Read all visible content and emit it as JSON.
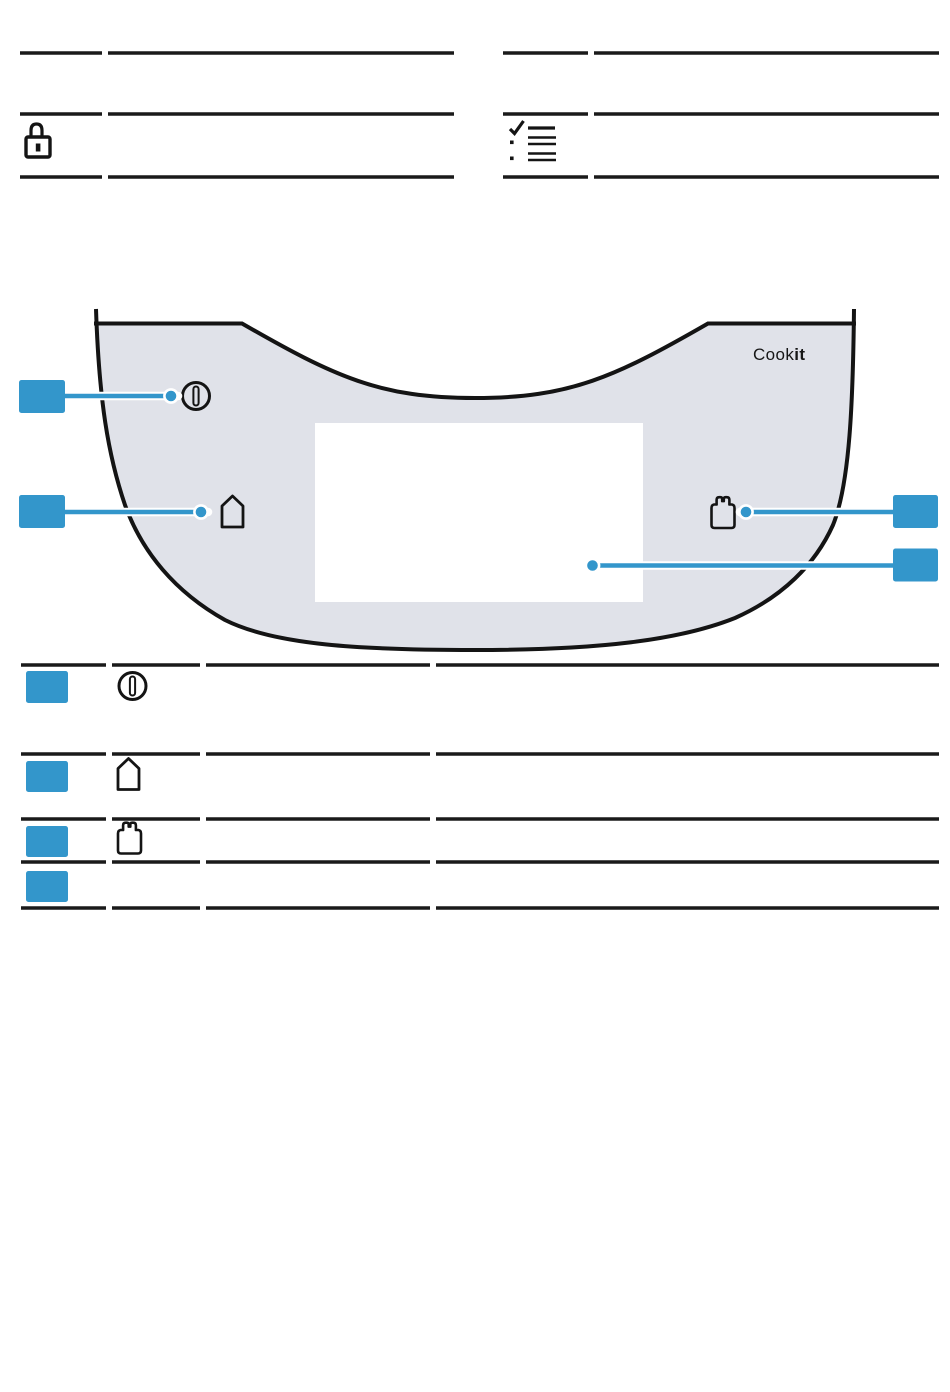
{
  "page": {
    "kind": "appliance-manual-page",
    "background": "#ffffff"
  },
  "colors": {
    "accent_blue": "#3396cb",
    "panel_fill": "#e0e2e9",
    "rule_black": "#1a1a1a",
    "display_white": "#ffffff"
  },
  "header": {
    "left_table": {
      "rows": [
        {
          "icon": null,
          "content": ""
        },
        {
          "icon": "lock-icon",
          "content": ""
        }
      ]
    },
    "right_table": {
      "rows": [
        {
          "icon": null,
          "content": ""
        },
        {
          "icon": "checklist-icon",
          "content": ""
        }
      ]
    }
  },
  "diagram": {
    "brand": {
      "regular": "Cook",
      "bold": "it"
    },
    "panel": "control-panel-surface",
    "display": "display-screen",
    "callouts": [
      {
        "position": "left-top",
        "target_icon": "power-icon"
      },
      {
        "position": "left-middle",
        "target_icon": "home-icon"
      },
      {
        "position": "right-top",
        "target_icon": "weight-icon"
      },
      {
        "position": "right-bottom",
        "target_icon": "display-screen"
      }
    ]
  },
  "legend": {
    "rows": [
      {
        "badge": "blue-box",
        "icon": "power-icon"
      },
      {
        "badge": "blue-box",
        "icon": "home-icon"
      },
      {
        "badge": "blue-box",
        "icon": "weight-icon"
      },
      {
        "badge": "blue-box",
        "icon": null
      }
    ]
  }
}
